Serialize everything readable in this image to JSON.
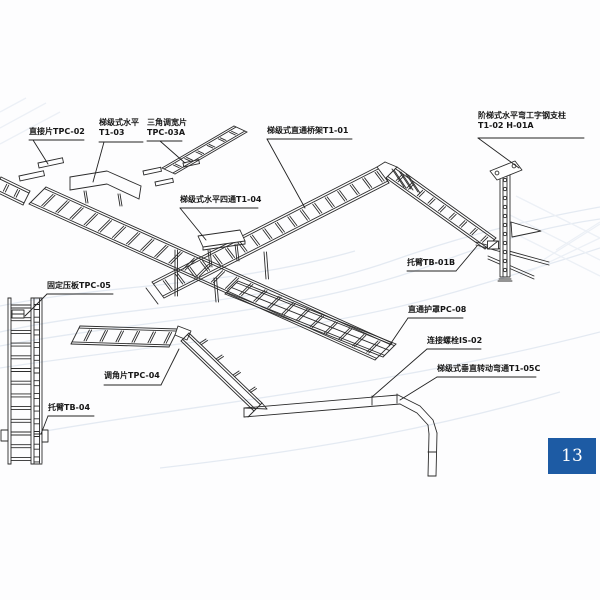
{
  "diagram": {
    "labels": {
      "tpc02": {
        "line1": "直接片TPC-02"
      },
      "t103": {
        "line1": "梯级式水平",
        "line2": "T1-03"
      },
      "tpc03a": {
        "line1": "三角调宽片",
        "line2": "TPC-03A"
      },
      "t101": {
        "line1": "梯级式直通桥架T1-01"
      },
      "h01a": {
        "line1": "阶梯式水平弯工字钢支柱",
        "line2": "T1-02 H-01A"
      },
      "t104": {
        "line1": "梯级式水平四通T1-04"
      },
      "tb01b": {
        "line1": "托臂TB-01B"
      },
      "pc08": {
        "line1": "直通护罩PC-08"
      },
      "is02": {
        "line1": "连接螺栓IS-02"
      },
      "t105c": {
        "line1": "梯级式垂直转动弯通T1-05C"
      },
      "tpc05": {
        "line1": "固定压板TPC-05"
      },
      "tpc04": {
        "line1": "调角片TPC-04"
      },
      "tb04": {
        "line1": "托臂TB-04"
      }
    },
    "page_number": "13",
    "badge_color": "#1d5ba4",
    "line_color": "#2b2b2b"
  }
}
